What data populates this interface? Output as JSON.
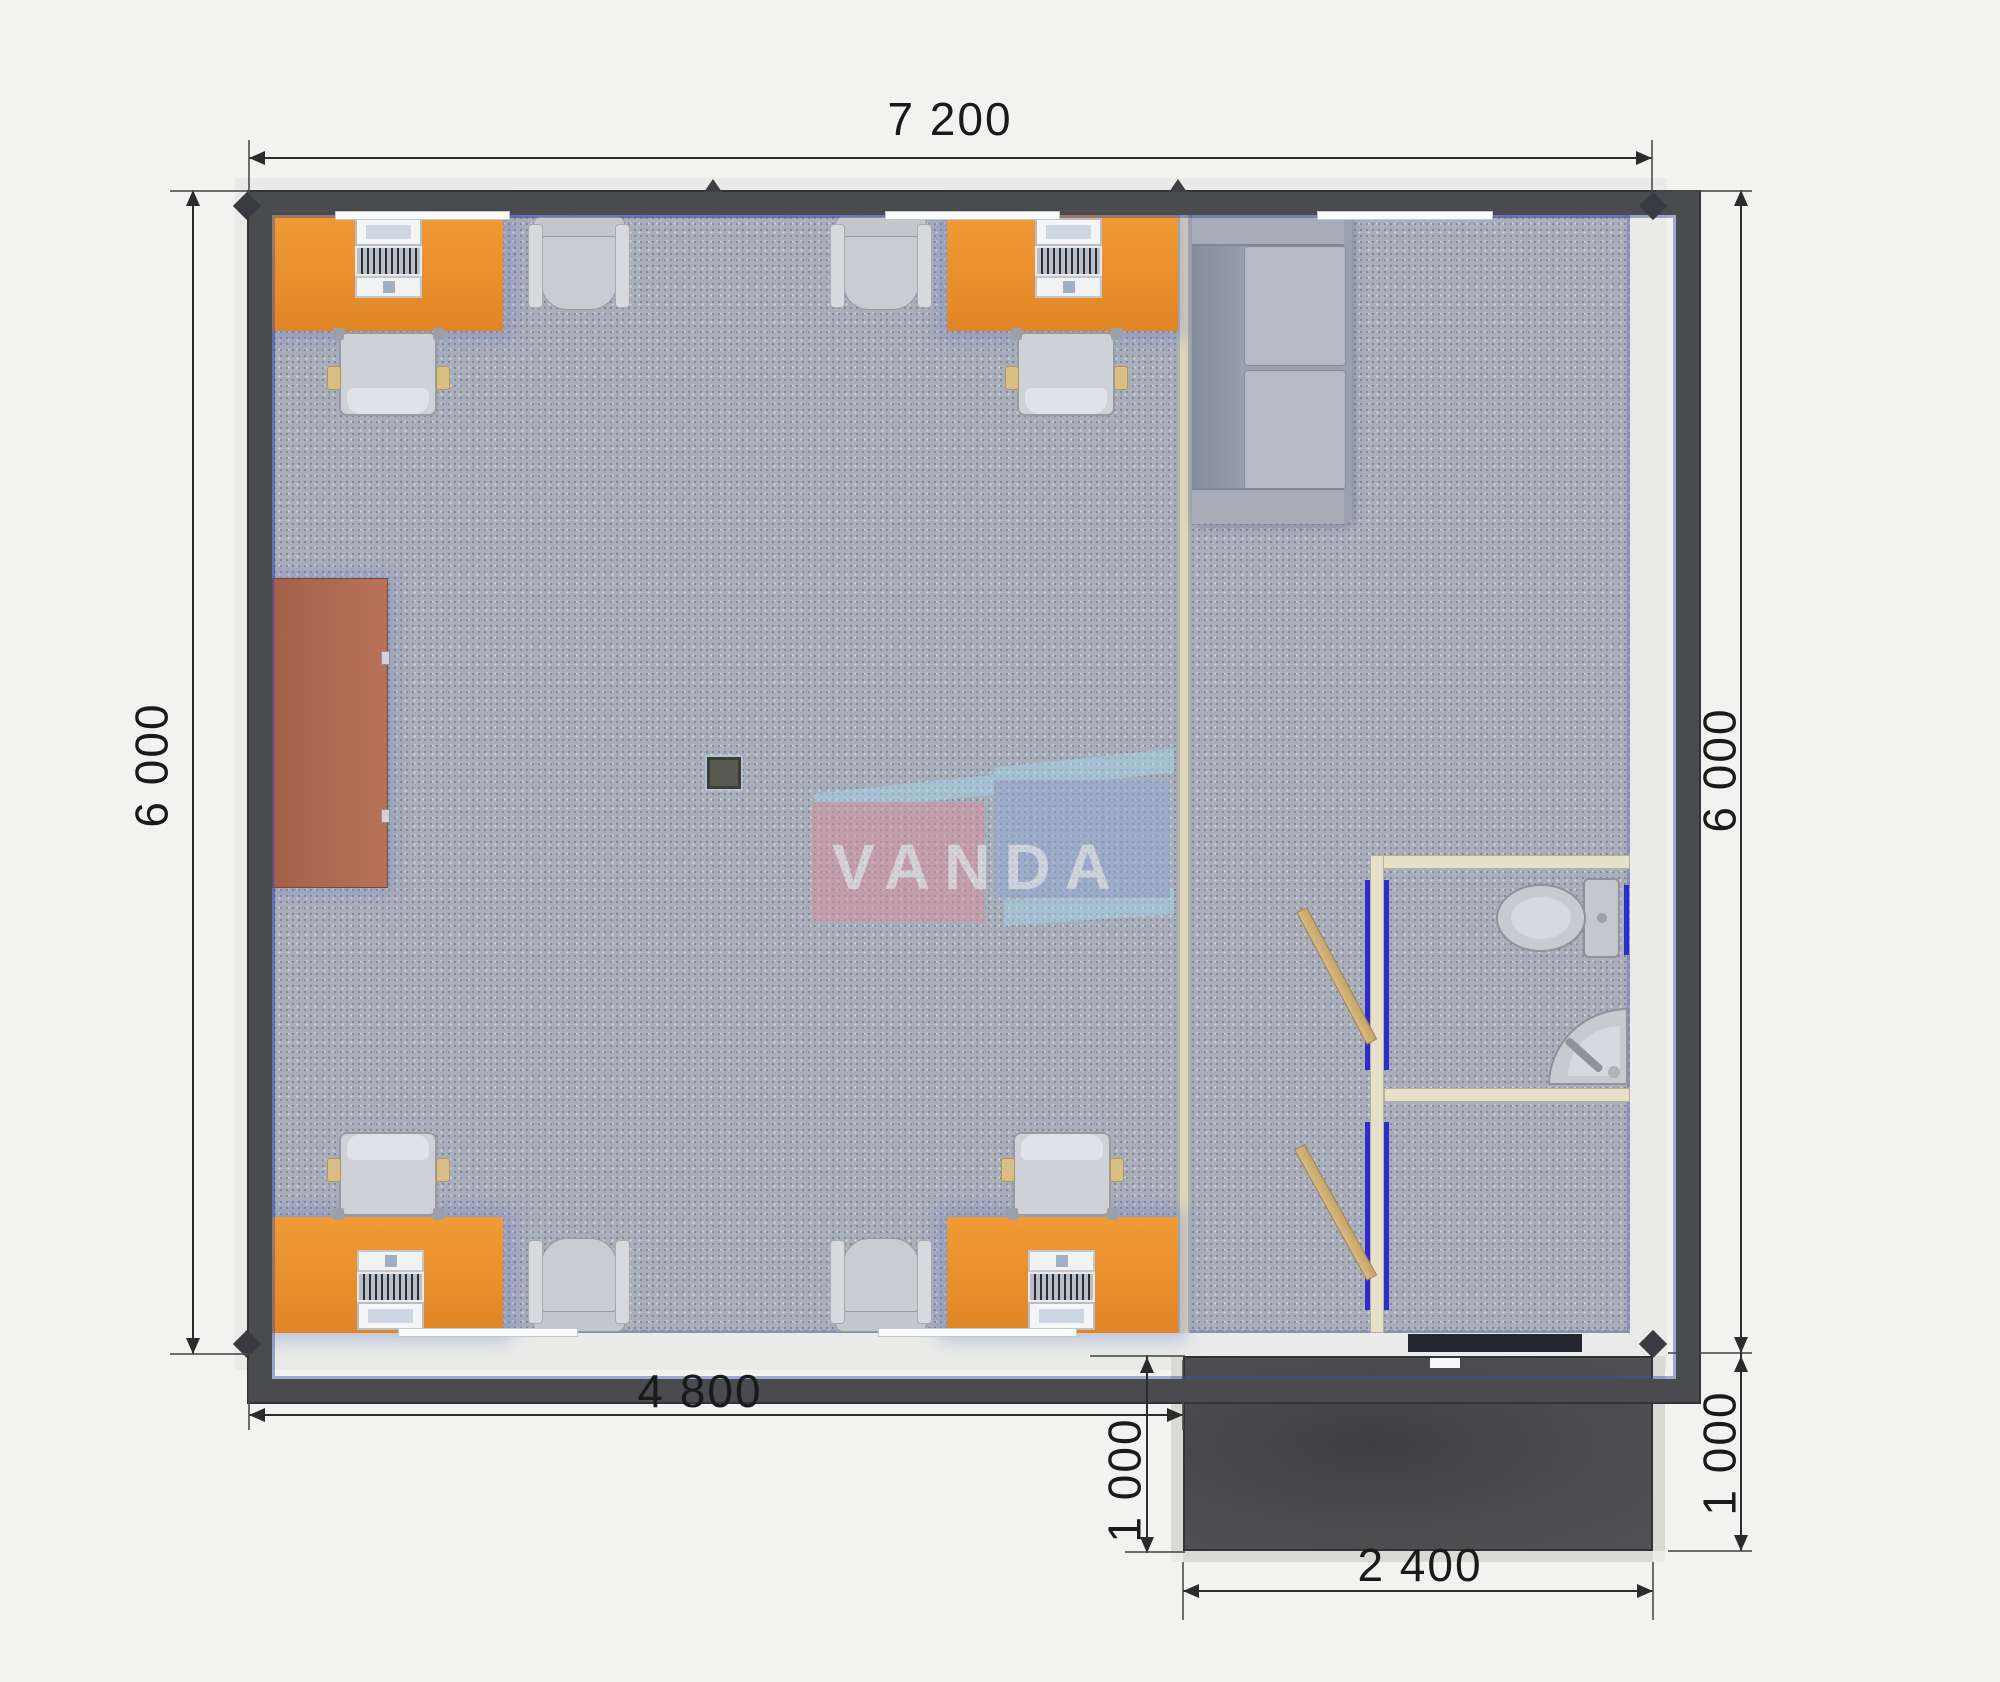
{
  "title": "Modular office floor plan render",
  "brand": {
    "name": "VANDA"
  },
  "dimensions": {
    "top_width": {
      "label": "7 200"
    },
    "left_height": {
      "label": "6 000"
    },
    "right_height": {
      "label": "6 000"
    },
    "office_width": {
      "label": "4 800"
    },
    "porch_depth_left": {
      "label": "1 000"
    },
    "porch_depth_right": {
      "label": "1 000"
    },
    "porch_width": {
      "label": "2 400"
    }
  },
  "colors": {
    "background": "#f2f2f0",
    "exterior_wall": "#4a4b4f",
    "carpet": "#a9aebb",
    "desk_orange": "#ee9732",
    "cabinet_brown": "#b06b52",
    "partition_cream": "#ded6bf",
    "door_wood": "#d2b27a",
    "door_jamb_blue": "#2b2bd0",
    "porch_dark": "#4a4a4c",
    "sofa_gray": "#9aa2af",
    "dimension_text": "#1a1a1a",
    "logo_pink": "#d9919d",
    "logo_blue": "#92a9d2",
    "logo_lightblue": "#a3d2e6"
  },
  "furniture": {
    "desks": 4,
    "computers": 4,
    "office_chairs": 4,
    "armchairs": 4,
    "sofa": 1,
    "cabinet": 1,
    "toilet": 1,
    "corner_sink": 1,
    "open_doors": 2
  }
}
